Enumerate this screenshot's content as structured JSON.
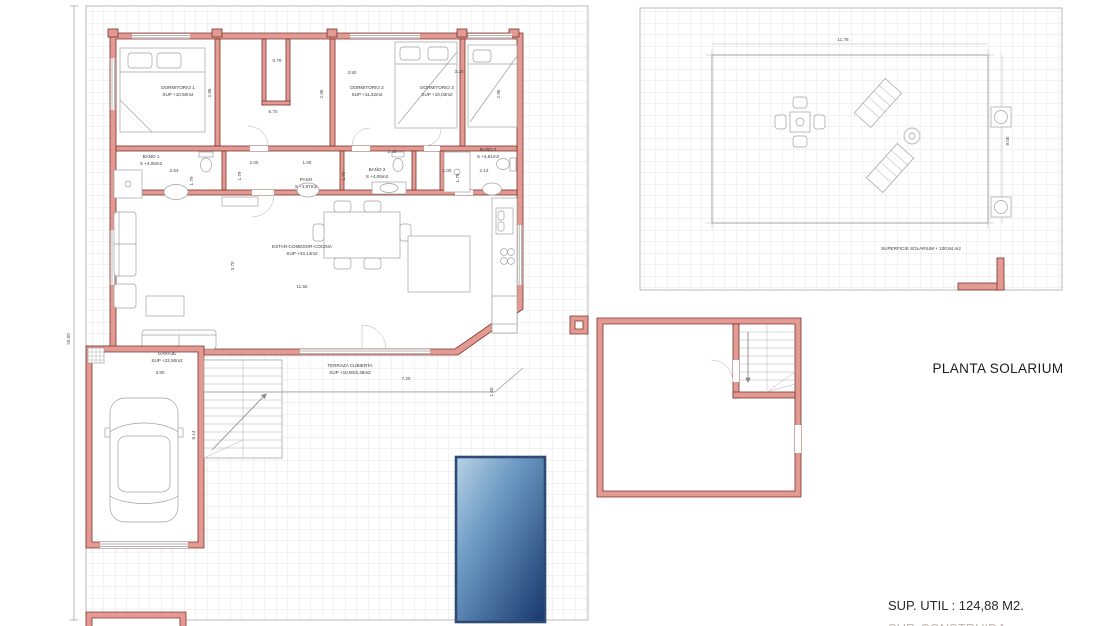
{
  "meta": {
    "drawing_type": "architectural floor plan, ground floor + solarium roof plan",
    "colors": {
      "wall_fill": "#e29a92",
      "wall_stroke": "#7a342c",
      "grid_line": "#dcdcdc",
      "drawing_line": "#9a9a9a",
      "pool_light": "#b9d3e6",
      "pool_mid": "#6f9cc4",
      "pool_dark": "#16366b",
      "pool_border": "#2e4b78",
      "text": "#3a3a3a"
    }
  },
  "titles": {
    "solarium_plan": "PLANTA SOLARIUM",
    "sup_util": "SUP. UTIL : 124,88 M2.",
    "sup_construida": "SUP. CONSTRUIDA :"
  },
  "rooms": {
    "dorm1": {
      "name": "DORMITORIO 1",
      "area": "SUP +10,50m2"
    },
    "dorm2": {
      "name": "DORMITORIO 2",
      "area": "SUP +11,32m2"
    },
    "dorm3": {
      "name": "DORMITORIO 3",
      "area": "SUP +10,03m2"
    },
    "bano1": {
      "name": "BAÑO 1",
      "area": "S +4,05m2"
    },
    "bano2": {
      "name": "BAÑO 2",
      "area": "S +4,06m2"
    },
    "bano3": {
      "name": "BAÑO 3",
      "area": "S +4,81m2"
    },
    "paso": {
      "name": "PASO",
      "area": "S +1,97m2"
    },
    "estar": {
      "name": "ESTAR-COMEDOR-COCINA",
      "area": "SUP +43,14m2"
    },
    "garaje": {
      "name": "GARAJE",
      "area": "SUP +22,50m2"
    },
    "terraza": {
      "name": "TERRAZA CUBIERTA",
      "area": "SUP +10,90/5,45m2"
    },
    "solarium_surface": "SUPERFICIE SOLARIUM + 100,84 m2"
  },
  "dims": {
    "plot_h": "20.00",
    "d296": "2.96",
    "d070": "0.70",
    "d350": "3.50",
    "d295": "2.95",
    "d670": "6.70",
    "d320": "3.20",
    "d263": "2.63",
    "d179": "1.79",
    "d200": "2.00",
    "d100": "1.00",
    "d240": "2.40",
    "d213": "2.13",
    "d370": "3.70",
    "d1155": "11.55",
    "d380": "3.80",
    "d614": "6.14",
    "d720": "7.20",
    "d160": "1.60",
    "d1178": "11.78",
    "d900": "9.00"
  }
}
